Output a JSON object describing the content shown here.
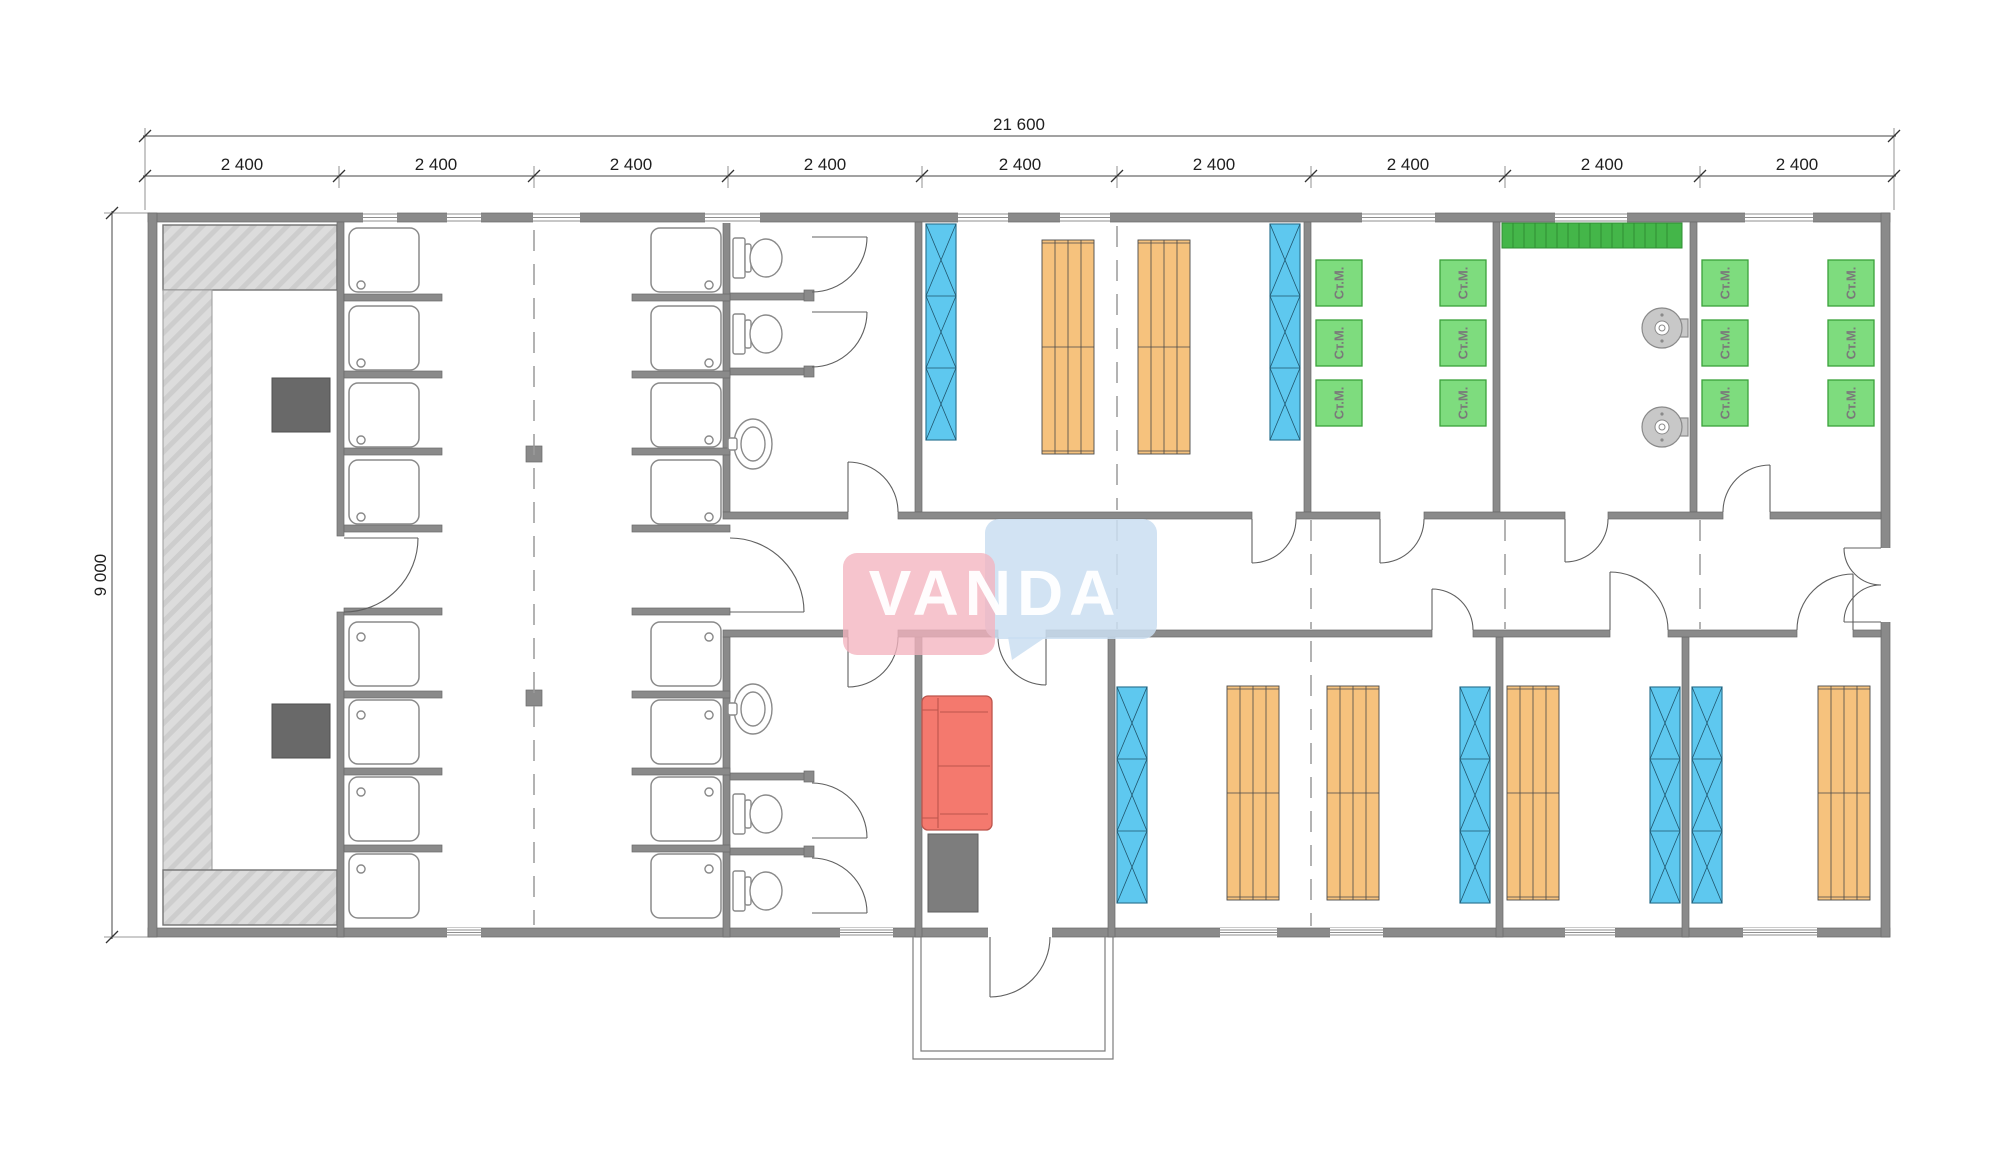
{
  "dimensions": {
    "total_width": "21 600",
    "module_width": "2 400",
    "module_count": 9,
    "height": "9 000"
  },
  "watermark": {
    "text": "VANDA"
  },
  "labels": {
    "washing_machine": "Ст.М."
  },
  "inventory": {
    "washing_machines": 12,
    "shower_cabins": 16,
    "toilets": 4,
    "sinks": 2,
    "bunk_beds": 6,
    "wardrobes": 6,
    "spin_dryers": 2,
    "sofas": 1,
    "sauna_stoves": 2
  },
  "colors": {
    "wall": "#8a8a8a",
    "dim_text": "#1f1f1f",
    "fixture_line": "#8a8a8a",
    "locker_blue": "#5ec8ef",
    "bunk_orange": "#f6c27d",
    "machine_green": "#7edc7e",
    "machine_green_border": "#3aa23a",
    "rack_green": "#44b649",
    "sofa_red": "#f4796e",
    "stove_gray": "#696969",
    "table_gray": "#7d7d7d",
    "dryer_gray": "#c8c8c8",
    "dash_line": "#9a9a9a",
    "watermark_pink": "#f3b3bf",
    "watermark_blue": "#cadef1"
  }
}
